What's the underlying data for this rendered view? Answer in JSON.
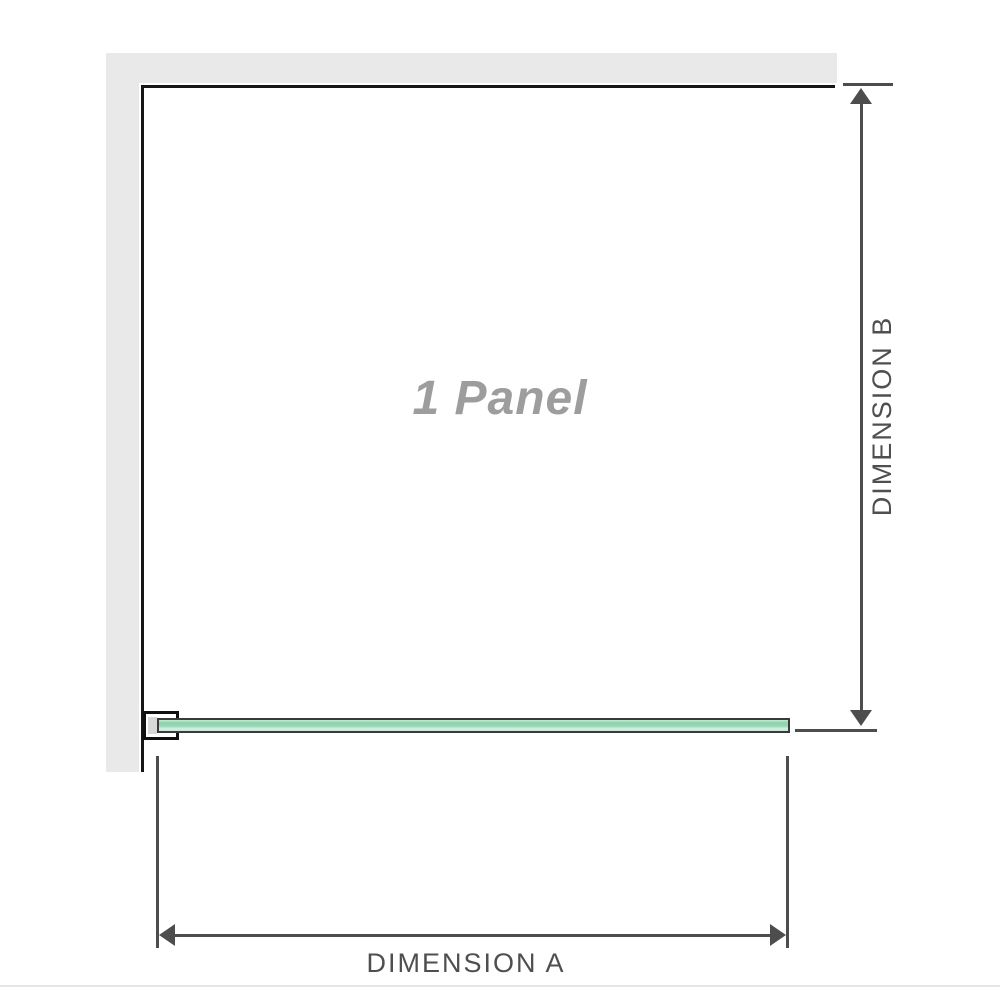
{
  "diagram": {
    "title": "1 panel shower screen dimension diagram",
    "panel_label": "1 Panel",
    "panel_count": 1,
    "dimension_a": {
      "label": "DIMENSION A",
      "orientation": "horizontal",
      "measures": "panel width"
    },
    "dimension_b": {
      "label": "DIMENSION B",
      "orientation": "vertical",
      "measures": "panel height"
    }
  },
  "colors": {
    "background": "#ffffff",
    "wall_gray": "#e9e9e9",
    "panel_border": "#161616",
    "dimension_lines": "#4d4d4d",
    "dimension_text": "#4f4f4f",
    "panel_label_gray": "#9d9d9d",
    "glass_green_main": "#8fd3ac",
    "glass_green_light": "#d5eee1",
    "glass_outline": "#3a3a3a",
    "bracket_border": "#101010",
    "bracket_shim": "#d8d8d8",
    "divider": "#e5e5e1"
  },
  "icons": {
    "arrow_up": "up-arrowhead",
    "arrow_down": "down-arrowhead",
    "arrow_left": "left-arrowhead",
    "arrow_right": "right-arrowhead"
  }
}
